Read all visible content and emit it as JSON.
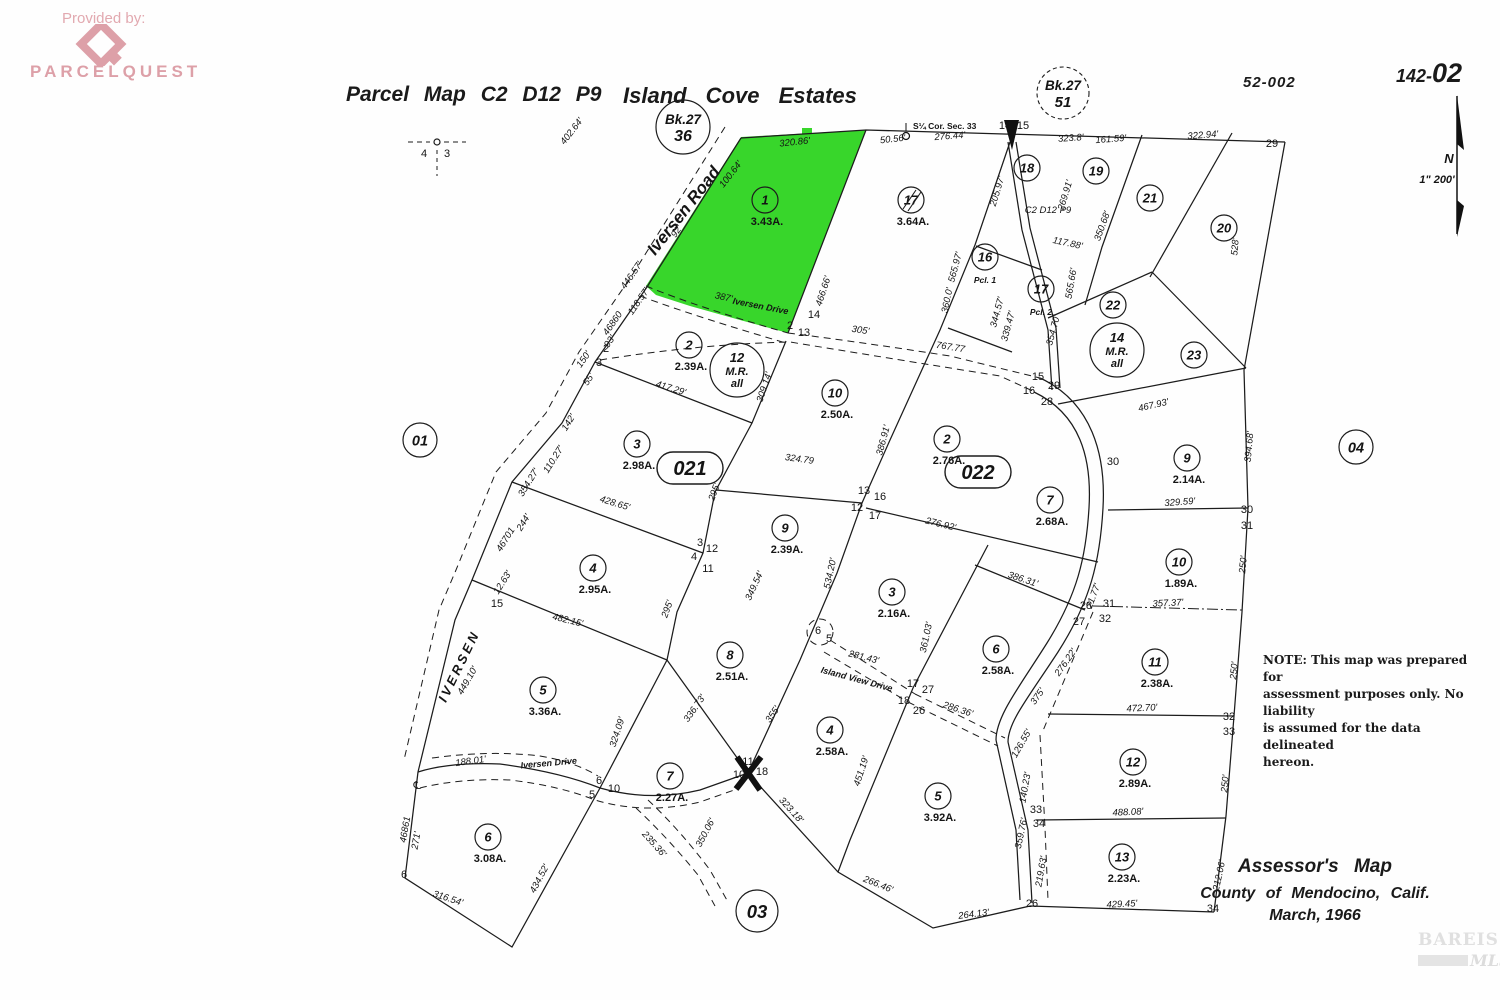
{
  "header": {
    "provided_by": "Provided by:",
    "brand": "PARCELQUEST",
    "title_left": "Parcel Map C2 D12 P9",
    "title_right": "Island Cove Estates",
    "sheet_code": "52-002",
    "page_code_prefix": "142-",
    "page_code_suffix": "02",
    "book_circle_left": {
      "line1": "Bk.27",
      "line2": "36"
    },
    "book_circle_right": {
      "line1": "Bk.27",
      "line2": "51"
    },
    "section_tick_left": "4",
    "section_tick_right": "3",
    "north_label": "N",
    "scale_label": "1\" 200'"
  },
  "note": {
    "lines": [
      "NOTE:  This map was prepared for",
      "assessment purposes only. No liability",
      "is assumed for the data delineated",
      "hereon."
    ]
  },
  "assessor": {
    "line1": "Assessor's  Map",
    "line2": "County of  Mendocino, Calif.",
    "line3": "March, 1966"
  },
  "watermark": {
    "brand": "BAREIS",
    "reg": "®",
    "mls": "MLS"
  },
  "map": {
    "highlight_color": "#38d62b",
    "corner_note": "S¼ Cor. Sec. 33",
    "parcels": [
      {
        "n": "1",
        "a": "3.43A.",
        "x": 765,
        "y": 200
      },
      {
        "n": "17",
        "a": "3.64A.",
        "x": 911,
        "y": 200,
        "strike": true
      },
      {
        "n": "18",
        "x": 1027,
        "y": 168
      },
      {
        "n": "19",
        "x": 1096,
        "y": 171
      },
      {
        "n": "21",
        "x": 1150,
        "y": 198
      },
      {
        "n": "20",
        "x": 1224,
        "y": 228
      },
      {
        "n": "16",
        "sub": "Pcl. 1",
        "x": 985,
        "y": 257
      },
      {
        "n": "17",
        "sub": "Pcl. 2",
        "x": 1041,
        "y": 289
      },
      {
        "n": "22",
        "x": 1113,
        "y": 305
      },
      {
        "n": "23",
        "x": 1194,
        "y": 355
      },
      {
        "n": "2",
        "a": "2.39A.",
        "x": 689,
        "y": 345
      },
      {
        "n": "10",
        "a": "2.50A.",
        "x": 835,
        "y": 393
      },
      {
        "n": "3",
        "a": "2.98A.",
        "x": 637,
        "y": 444
      },
      {
        "n": "2",
        "a": "2.76A.",
        "x": 947,
        "y": 439
      },
      {
        "n": "9",
        "a": "2.39A.",
        "x": 785,
        "y": 528
      },
      {
        "n": "7",
        "a": "2.68A.",
        "x": 1050,
        "y": 500
      },
      {
        "n": "4",
        "a": "2.95A.",
        "x": 593,
        "y": 568
      },
      {
        "n": "9",
        "a": "2.14A.",
        "x": 1187,
        "y": 458
      },
      {
        "n": "10",
        "a": "1.89A.",
        "x": 1179,
        "y": 562
      },
      {
        "n": "3",
        "a": "2.16A.",
        "x": 892,
        "y": 592
      },
      {
        "n": "6",
        "a": "2.58A.",
        "x": 996,
        "y": 649
      },
      {
        "n": "11",
        "a": "2.38A.",
        "x": 1155,
        "y": 662
      },
      {
        "n": "5",
        "a": "3.36A.",
        "x": 543,
        "y": 690
      },
      {
        "n": "8",
        "a": "2.51A.",
        "x": 730,
        "y": 655
      },
      {
        "n": "4",
        "a": "2.58A.",
        "x": 830,
        "y": 730
      },
      {
        "n": "12",
        "a": "2.89A.",
        "x": 1133,
        "y": 762
      },
      {
        "n": "7",
        "a": "2.27A.",
        "x": 670,
        "y": 776
      },
      {
        "n": "5",
        "a": "3.92A.",
        "x": 938,
        "y": 796
      },
      {
        "n": "6",
        "a": "3.08A.",
        "x": 488,
        "y": 837
      },
      {
        "n": "13",
        "a": "2.23A.",
        "x": 1122,
        "y": 857
      }
    ],
    "mr_parcels": [
      {
        "lines": [
          "12",
          "M.R.",
          "all"
        ],
        "x": 737,
        "y": 370
      },
      {
        "lines": [
          "14",
          "M.R.",
          "all"
        ],
        "x": 1117,
        "y": 350
      }
    ],
    "area_circles": [
      {
        "label": "01",
        "x": 420,
        "y": 440,
        "r": 17
      },
      {
        "label": "04",
        "x": 1356,
        "y": 447,
        "r": 17
      },
      {
        "label": "03",
        "x": 757,
        "y": 911,
        "r": 21
      }
    ],
    "area_ovals": [
      {
        "label": "021",
        "x": 690,
        "y": 468
      },
      {
        "label": "022",
        "x": 978,
        "y": 472
      }
    ],
    "roads": [
      {
        "t": "Iversen Road",
        "x": 688,
        "y": 214,
        "r": -52,
        "size": 17
      },
      {
        "t": "IVERSEN",
        "x": 463,
        "y": 668,
        "r": -64,
        "size": 13,
        "ls": 3
      },
      {
        "t": "Iversen Drive",
        "x": 549,
        "y": 766,
        "r": -5,
        "size": 9
      },
      {
        "t": "Iversen Drive",
        "x": 760,
        "y": 309,
        "r": 11,
        "size": 9
      },
      {
        "t": "Island View Drive",
        "x": 856,
        "y": 682,
        "r": 15,
        "size": 9
      }
    ],
    "lot_numbers": [
      {
        "t": "14",
        "x": 1005,
        "y": 129
      },
      {
        "t": "15",
        "x": 1023,
        "y": 129
      },
      {
        "t": "29",
        "x": 1272,
        "y": 147
      },
      {
        "t": "14",
        "x": 814,
        "y": 318
      },
      {
        "t": "2",
        "x": 790,
        "y": 329
      },
      {
        "t": "13",
        "x": 804,
        "y": 336
      },
      {
        "t": "15",
        "x": 1038,
        "y": 380
      },
      {
        "t": "29",
        "x": 1054,
        "y": 389
      },
      {
        "t": "16",
        "x": 1029,
        "y": 394
      },
      {
        "t": "28",
        "x": 1047,
        "y": 405
      },
      {
        "t": "13",
        "x": 864,
        "y": 494
      },
      {
        "t": "16",
        "x": 880,
        "y": 500
      },
      {
        "t": "12",
        "x": 857,
        "y": 511
      },
      {
        "t": "17",
        "x": 875,
        "y": 519
      },
      {
        "t": "3",
        "x": 700,
        "y": 546
      },
      {
        "t": "12",
        "x": 712,
        "y": 552
      },
      {
        "t": "4",
        "x": 694,
        "y": 560
      },
      {
        "t": "11",
        "x": 708,
        "y": 572
      },
      {
        "t": "30",
        "x": 1113,
        "y": 465
      },
      {
        "t": "30",
        "x": 1247,
        "y": 513
      },
      {
        "t": "31",
        "x": 1247,
        "y": 529
      },
      {
        "t": "28",
        "x": 1086,
        "y": 609
      },
      {
        "t": "31",
        "x": 1109,
        "y": 607
      },
      {
        "t": "27",
        "x": 1079,
        "y": 625
      },
      {
        "t": "32",
        "x": 1105,
        "y": 622
      },
      {
        "t": "32",
        "x": 1229,
        "y": 720
      },
      {
        "t": "33",
        "x": 1229,
        "y": 735
      },
      {
        "t": "17",
        "x": 913,
        "y": 687
      },
      {
        "t": "27",
        "x": 928,
        "y": 693
      },
      {
        "t": "18",
        "x": 904,
        "y": 704
      },
      {
        "t": "26",
        "x": 919,
        "y": 714
      },
      {
        "t": "33",
        "x": 1036,
        "y": 813
      },
      {
        "t": "34",
        "x": 1039,
        "y": 827
      },
      {
        "t": "26",
        "x": 1032,
        "y": 907
      },
      {
        "t": "34",
        "x": 1213,
        "y": 912
      },
      {
        "t": "11",
        "x": 748,
        "y": 765
      },
      {
        "t": "10",
        "x": 739,
        "y": 778
      },
      {
        "t": "18",
        "x": 762,
        "y": 775
      },
      {
        "t": "6",
        "x": 599,
        "y": 784
      },
      {
        "t": "10",
        "x": 614,
        "y": 792
      },
      {
        "t": "5",
        "x": 592,
        "y": 798
      },
      {
        "t": "15",
        "x": 497,
        "y": 607
      },
      {
        "t": "2",
        "x": 606,
        "y": 352
      },
      {
        "t": "3",
        "x": 599,
        "y": 366
      },
      {
        "t": "6",
        "x": 404,
        "y": 878
      },
      {
        "t": "6",
        "x": 818,
        "y": 634
      },
      {
        "t": "5",
        "x": 829,
        "y": 642
      },
      {
        "t": "℄",
        "x": 417,
        "y": 789
      }
    ],
    "measurements": [
      {
        "t": "320.86'",
        "x": 795,
        "y": 145,
        "r": -6
      },
      {
        "t": "50.56'",
        "x": 893,
        "y": 142,
        "r": -6
      },
      {
        "t": "276.44'",
        "x": 950,
        "y": 139,
        "r": -4
      },
      {
        "t": "323.8'",
        "x": 1071,
        "y": 141,
        "r": -4
      },
      {
        "t": "161.59'",
        "x": 1111,
        "y": 142,
        "r": -4
      },
      {
        "t": "322.94'",
        "x": 1203,
        "y": 138,
        "r": -4
      },
      {
        "t": "402.64'",
        "x": 574,
        "y": 133,
        "r": -52
      },
      {
        "t": "100.64'",
        "x": 733,
        "y": 176,
        "r": -52
      },
      {
        "t": "466.66'",
        "x": 826,
        "y": 292,
        "r": -72
      },
      {
        "t": "92'",
        "x": 679,
        "y": 233,
        "r": -55
      },
      {
        "t": "446.57'",
        "x": 634,
        "y": 277,
        "r": -55
      },
      {
        "t": "118.57'",
        "x": 641,
        "y": 303,
        "r": -55
      },
      {
        "t": "46860",
        "x": 615,
        "y": 325,
        "r": -55
      },
      {
        "t": "93'",
        "x": 612,
        "y": 343,
        "r": -55
      },
      {
        "t": "150'",
        "x": 586,
        "y": 361,
        "r": -55
      },
      {
        "t": "55'",
        "x": 591,
        "y": 381,
        "r": -55
      },
      {
        "t": "387'",
        "x": 723,
        "y": 300,
        "r": 12
      },
      {
        "t": "305'",
        "x": 860,
        "y": 333,
        "r": 8
      },
      {
        "t": "767.77",
        "x": 950,
        "y": 350,
        "r": 9
      },
      {
        "t": "417.29'",
        "x": 670,
        "y": 391,
        "r": 17
      },
      {
        "t": "309.14'",
        "x": 767,
        "y": 388,
        "r": -72
      },
      {
        "t": "324.79",
        "x": 799,
        "y": 462,
        "r": 8
      },
      {
        "t": "295'",
        "x": 717,
        "y": 493,
        "r": -70
      },
      {
        "t": "428.65'",
        "x": 614,
        "y": 506,
        "r": 17
      },
      {
        "t": "386.91'",
        "x": 886,
        "y": 441,
        "r": -75
      },
      {
        "t": "276.92'",
        "x": 940,
        "y": 527,
        "r": 14
      },
      {
        "t": "142'",
        "x": 571,
        "y": 424,
        "r": -58
      },
      {
        "t": "110.27'",
        "x": 556,
        "y": 461,
        "r": -58
      },
      {
        "t": "354.27'",
        "x": 531,
        "y": 484,
        "r": -58
      },
      {
        "t": "244'",
        "x": 526,
        "y": 524,
        "r": -58
      },
      {
        "t": "46701",
        "x": 508,
        "y": 541,
        "r": -58
      },
      {
        "t": "12.63'",
        "x": 505,
        "y": 584,
        "r": -58
      },
      {
        "t": "482.15'",
        "x": 567,
        "y": 623,
        "r": 14
      },
      {
        "t": "295'",
        "x": 670,
        "y": 610,
        "r": -70
      },
      {
        "t": "349.54'",
        "x": 757,
        "y": 587,
        "r": -65
      },
      {
        "t": "534.20'",
        "x": 833,
        "y": 574,
        "r": -78
      },
      {
        "t": "361.03'",
        "x": 929,
        "y": 638,
        "r": -78
      },
      {
        "t": "386.31'",
        "x": 1022,
        "y": 582,
        "r": 18
      },
      {
        "t": "449.10'",
        "x": 470,
        "y": 682,
        "r": -60
      },
      {
        "t": "188.01'",
        "x": 471,
        "y": 764,
        "r": -8
      },
      {
        "t": "46861",
        "x": 408,
        "y": 830,
        "r": -80
      },
      {
        "t": "271'",
        "x": 419,
        "y": 841,
        "r": -80
      },
      {
        "t": "316.54'",
        "x": 447,
        "y": 901,
        "r": 18
      },
      {
        "t": "434.52'",
        "x": 542,
        "y": 880,
        "r": -62
      },
      {
        "t": "324.09'",
        "x": 620,
        "y": 733,
        "r": -72
      },
      {
        "t": "336.73'",
        "x": 697,
        "y": 710,
        "r": -55
      },
      {
        "t": "355'",
        "x": 775,
        "y": 716,
        "r": -55
      },
      {
        "t": "451.19'",
        "x": 864,
        "y": 772,
        "r": -72
      },
      {
        "t": "323.18'",
        "x": 789,
        "y": 812,
        "r": 48
      },
      {
        "t": "350.06'",
        "x": 708,
        "y": 834,
        "r": -62
      },
      {
        "t": "235.36'",
        "x": 652,
        "y": 846,
        "r": 48
      },
      {
        "t": "266.46'",
        "x": 877,
        "y": 887,
        "r": 22
      },
      {
        "t": "264.13'",
        "x": 974,
        "y": 917,
        "r": -7
      },
      {
        "t": "375'",
        "x": 1040,
        "y": 698,
        "r": -55
      },
      {
        "t": "276.22'",
        "x": 1068,
        "y": 664,
        "r": -55
      },
      {
        "t": "126.55'",
        "x": 1024,
        "y": 745,
        "r": -60
      },
      {
        "t": "140.23'",
        "x": 1028,
        "y": 788,
        "r": -80
      },
      {
        "t": "359.76'",
        "x": 1024,
        "y": 834,
        "r": -78
      },
      {
        "t": "219.63'",
        "x": 1044,
        "y": 872,
        "r": -80
      },
      {
        "t": "286.36'",
        "x": 957,
        "y": 712,
        "r": 18
      },
      {
        "t": "281.43'",
        "x": 863,
        "y": 660,
        "r": 14
      },
      {
        "t": "329.59'",
        "x": 1180,
        "y": 505,
        "r": -4
      },
      {
        "t": "250'",
        "x": 1246,
        "y": 565,
        "r": -84
      },
      {
        "t": "357.37'",
        "x": 1168,
        "y": 606,
        "r": -3
      },
      {
        "t": "21.77'",
        "x": 1096,
        "y": 597,
        "r": -70
      },
      {
        "t": "250'",
        "x": 1237,
        "y": 671,
        "r": -84
      },
      {
        "t": "472.70'",
        "x": 1142,
        "y": 711,
        "r": -3
      },
      {
        "t": "250'",
        "x": 1228,
        "y": 784,
        "r": -84
      },
      {
        "t": "488.08'",
        "x": 1128,
        "y": 815,
        "r": -3
      },
      {
        "t": "212.06'",
        "x": 1222,
        "y": 876,
        "r": -78
      },
      {
        "t": "429.45'",
        "x": 1122,
        "y": 907,
        "r": -3
      },
      {
        "t": "467.93'",
        "x": 1154,
        "y": 408,
        "r": -13
      },
      {
        "t": "394.68'",
        "x": 1252,
        "y": 447,
        "r": -85
      },
      {
        "t": "528'",
        "x": 1238,
        "y": 247,
        "r": -85
      },
      {
        "t": "205.97'",
        "x": 1000,
        "y": 192,
        "r": -73
      },
      {
        "t": "269.91'",
        "x": 1068,
        "y": 196,
        "r": -73
      },
      {
        "t": "350.68'",
        "x": 1105,
        "y": 227,
        "r": -70
      },
      {
        "t": "C2 D12 P9",
        "x": 1048,
        "y": 213,
        "r": 0
      },
      {
        "t": "565.97'",
        "x": 958,
        "y": 268,
        "r": -75
      },
      {
        "t": "360.0'",
        "x": 950,
        "y": 301,
        "r": -78
      },
      {
        "t": "344.57'",
        "x": 1000,
        "y": 313,
        "r": -75
      },
      {
        "t": "339.47'",
        "x": 1011,
        "y": 327,
        "r": -75
      },
      {
        "t": "354.70'",
        "x": 1056,
        "y": 331,
        "r": -75
      },
      {
        "t": "565.66'",
        "x": 1074,
        "y": 284,
        "r": -80
      },
      {
        "t": "117.88'",
        "x": 1067,
        "y": 246,
        "r": 12
      }
    ]
  }
}
